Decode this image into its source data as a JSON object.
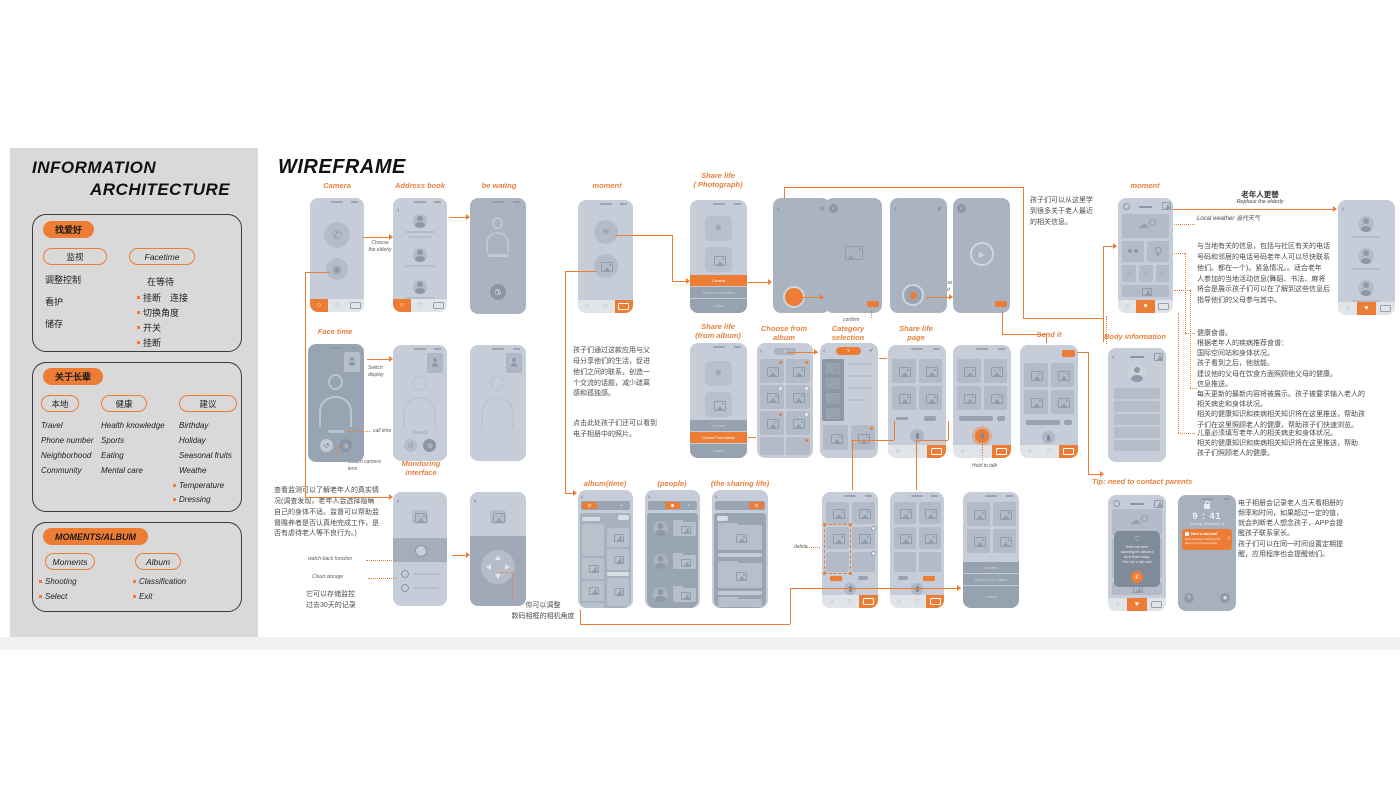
{
  "colors": {
    "accent": "#ED7C35",
    "phone_light": "#C7CDD8",
    "phone_mid": "#AAB4C1",
    "phone_dark": "#99A4B3",
    "panel_bg": "#D9D9D9"
  },
  "icons": {
    "home": "○",
    "heart": "♡",
    "heart_filled": "♥",
    "call": "✆",
    "camera": "◉",
    "switch": "↺",
    "play": "▶",
    "smiley": "☺",
    "cloud": "☁",
    "check": "✓",
    "chevron": "›",
    "back": "‹",
    "aperture": "✳",
    "clock": "⊙",
    "person": "☻",
    "plus": "+",
    "dropdown": "˅",
    "flash": "ϟ",
    "dot": "·"
  },
  "sidebar": {
    "title1": "INFORMATION",
    "title2": "ARCHITECTURE",
    "hobby": {
      "tag": "找爱好",
      "pill_monitor": "监视",
      "pill_facetime": "Facetime",
      "left_items": [
        "调整控制",
        "看护",
        "储存"
      ],
      "right_header": "在等待",
      "right_items": [
        "挂断　连接",
        "切换角度",
        "开关",
        "挂断"
      ]
    },
    "elders": {
      "tag": "关于长辈",
      "pill_local": "本地",
      "pill_health": "健康",
      "pill_advice": "建议",
      "local_items": [
        "Travel",
        "Phone number",
        "Neighborhood",
        "Community"
      ],
      "health_items": [
        "Health knowledge",
        "Sports",
        "Eating",
        "Mental care"
      ],
      "advice_items": [
        "Birthday",
        "Holiday",
        "Seasonal fruits",
        "Weathe"
      ],
      "advice_bullets": [
        "Temperature",
        "Dressing"
      ]
    },
    "moments": {
      "tag": "MOMENTS/ALBUM",
      "pill_moments": "Moments",
      "pill_album": "Album",
      "moments_bullets": [
        "Shooting",
        "Select"
      ],
      "album_bullets": [
        "Classification",
        "Exit"
      ]
    }
  },
  "main": {
    "title": "WIREFRAME",
    "labels": {
      "camera": "Camera",
      "address_book": "Address book",
      "be_waiting": "be wating",
      "face_time": "Face time",
      "monitoring": "Monitoring\ninterface",
      "moment_left": "moment",
      "share_life_photo": "Share life\n( Photograph)",
      "share_life_album": "Share life\n(from album)",
      "choose_from_album": "Choose from\nalbum",
      "category_selection": "Category\nselection",
      "share_life_page": "Share life\npage",
      "send_it": "Send it",
      "album_time": "album(time)",
      "people": "(people)",
      "sharing_life": "(the sharing life)",
      "moment_right": "moment",
      "body_information": "Body information",
      "tip": "Tip: need to contact parents"
    },
    "annotations": {
      "choose_elderly": "Choose\nthe elderly",
      "switch_display": "Switch\ndisplay",
      "call_time": "call time",
      "switch_camera": "Switch camera\nlens",
      "watch_back": "watch-back function",
      "cloud_storage": "Cloud storage",
      "click_take_photo": "Click to take\na photo",
      "confirm": "confirm",
      "long_press": "Long press\nto record",
      "hold_to_talk": "Hold to talk",
      "delete": "delete",
      "local_weather": "Local weather  当代天气",
      "replace_title": "老年人更替",
      "replace_sub": "Replace the elderly"
    },
    "notes": {
      "monitor": "查看监测可以了解老年人的真实情\n况(调查发现，老年人会选择隐瞒\n自己的身体不适。监督可以帮助监\n督赡养者是否认真地完成工作，是\n否有虐待老人等不良行为。)",
      "storage": "它可以存储监控\n过去30天的记录",
      "adjust": "你可以调整\n数码相框的相机角度",
      "share": "孩子们通过这款应用与父\n母分享他们的生活，促进\n他们之间的联系，创造一\n个交流的话题，减少疏离\n感和孤独感。",
      "click_album": "点击此处孩子们还可以看到\n电子相册中的照片。",
      "learn": "孩子们可以从这里学\n到很多关于老人最近\n的相关信息。",
      "local_info": "与当地有关的信息，包括与社区有关的电话\n号码和邻居的电话号码老年人可以尽快联系\n他们。都在一个)。紧急情况。。适合老年\n人参加的当地活动信息(舞蹈、书法、麻将\n将会是展示孩子们可以在了解到这些信息后\n指导他们的父母参与其中。",
      "recipe": "健康食谱。\n根据老年人的疾病推荐食谱：\n国际空间站和身体状况。\n孩子看到之后，他就能。\n建议他的父母在饮食方面照顾他父母的健康。",
      "push": "信息推送。\n每天更新的最新内容将被展示。孩子被要求输入老人的\n相关病史和身体状况。\n相关的健康知识和疾病相关知识将在这里推送，帮助孩\n子们在这里照顾老人的健康，帮助孩子们快速浏览。",
      "children": "儿童必须填写老年人的相关病史和身体状况。\n相关的健康知识和疾病相关知识将在这里推送，帮助\n孩子们照顾老人的健康。",
      "album_record": "电子相册会记录老人当天看相册的\n频率和时间，如果超过一定的值，\n就会判断老人想念孩子，APP会提\n醒孩子联系家长。\n孩子们可以在同一时间设置定期提\n醒，应用程序也会提醒他们。"
    },
    "screen": {
      "sheet_camera": "Camera",
      "sheet_choose": "Choose From Album",
      "sheet_cancel": "Cancel",
      "lock_time": "9 : 41",
      "lock_date": "Tuesday, September 11",
      "notif_title": "Have a call now!",
      "notif_body": "Dulin has been watching the album a lot of times today",
      "popup": "Dulin has been\nscanning the album a\nlot of times today.\nGive her a call now!"
    }
  }
}
